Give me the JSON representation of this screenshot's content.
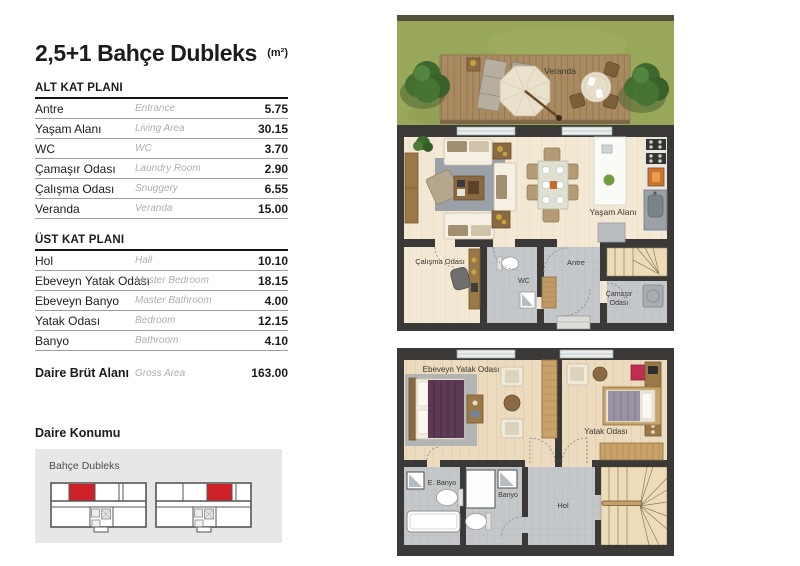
{
  "header": {
    "title": "2,5+1 Bahçe Dubleks",
    "unit": "(m²)"
  },
  "tables": {
    "alt": {
      "heading": "ALT KAT PLANI",
      "rows": [
        {
          "tr": "Antre",
          "en": "Entrance",
          "value": "5.75"
        },
        {
          "tr": "Yaşam Alanı",
          "en": "Living Area",
          "value": "30.15"
        },
        {
          "tr": "WC",
          "en": "WC",
          "value": "3.70"
        },
        {
          "tr": "Çamaşır Odası",
          "en": "Laundry Room",
          "value": "2.90"
        },
        {
          "tr": "Çalışma Odası",
          "en": "Snuggery",
          "value": "6.55"
        },
        {
          "tr": "Veranda",
          "en": "Veranda",
          "value": "15.00"
        }
      ]
    },
    "ust": {
      "heading": "ÜST KAT PLANI",
      "rows": [
        {
          "tr": "Hol",
          "en": "Hall",
          "value": "10.10"
        },
        {
          "tr": "Ebeveyn Yatak Odası",
          "en": "Master Bedroom",
          "value": "18.15"
        },
        {
          "tr": "Ebeveyn Banyo",
          "en": "Master Bathroom",
          "value": "4.00"
        },
        {
          "tr": "Yatak Odası",
          "en": "Bedroom",
          "value": "12.15"
        },
        {
          "tr": "Banyo",
          "en": "Bathroom",
          "value": "4.10"
        }
      ]
    },
    "total": {
      "tr": "Daire Brüt Alanı",
      "en": "Gross Area",
      "value": "163.00"
    }
  },
  "location": {
    "heading": "Daire Konumu",
    "label": "Bahçe Dubleks",
    "highlight_color": "#ce2127"
  },
  "plan1": {
    "labels": {
      "veranda": "Veranda",
      "yasam": "Yaşam Alanı",
      "calisma": "Çalışma Odası",
      "wc": "WC",
      "antre": "Antre",
      "camasir_line1": "Çamaşır",
      "camasir_line2": "Odası"
    }
  },
  "plan2": {
    "labels": {
      "ebeveyn": "Ebeveyn Yatak Odası",
      "yatak": "Yatak Odası",
      "e_banyo": "E. Banyo",
      "banyo": "Banyo",
      "hol": "Hol"
    }
  },
  "colors": {
    "accent_red": "#ce2127",
    "grass_green": "#99a75a",
    "wall_dark": "#3a3937",
    "floor_cream": "#f3e8d4",
    "tile_gray": "#c5c8cb"
  }
}
